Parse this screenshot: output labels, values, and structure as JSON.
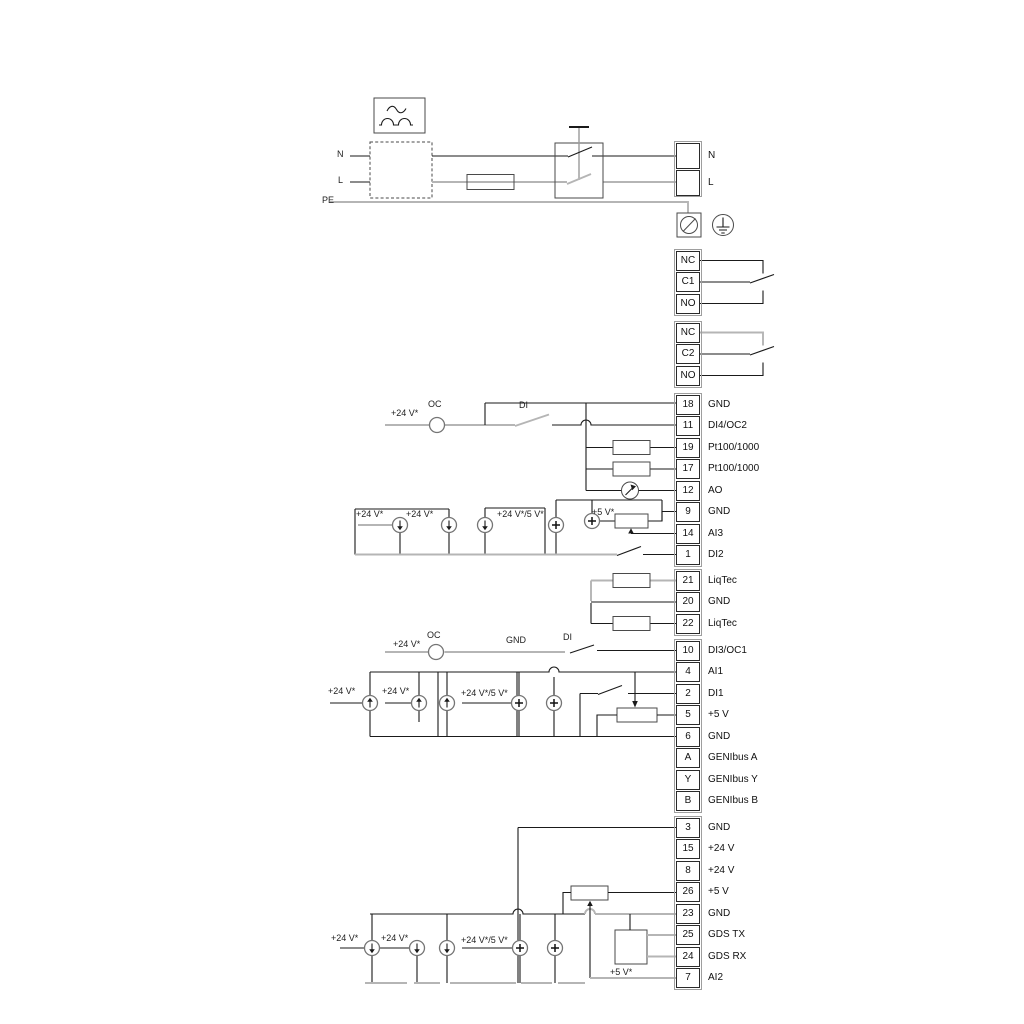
{
  "colors": {
    "wire_black": "#1a1a1a",
    "wire_gray": "#b5b5b5",
    "text": "#111111",
    "background": "#ffffff"
  },
  "annotations": [
    {
      "name": "n-input-label",
      "text": "N",
      "x": 337,
      "y": 149
    },
    {
      "name": "l-input-label",
      "text": "L",
      "x": 338,
      "y": 175
    },
    {
      "name": "pe-label",
      "text": "PE",
      "x": 322,
      "y": 195
    },
    {
      "name": "oc2-supply-label",
      "text": "+24 V*",
      "x": 391,
      "y": 408
    },
    {
      "name": "oc2-label",
      "text": "OC",
      "x": 428,
      "y": 399
    },
    {
      "name": "di4-label",
      "text": "DI",
      "x": 519,
      "y": 400
    },
    {
      "name": "ai3-supply1-label",
      "text": "+24 V*",
      "x": 356,
      "y": 509
    },
    {
      "name": "ai3-supply2-label",
      "text": "+24 V*",
      "x": 406,
      "y": 509
    },
    {
      "name": "ai3-supply3-label",
      "text": "+24 V*/5 V*",
      "x": 497,
      "y": 509
    },
    {
      "name": "ai3-5v-label",
      "text": "+5 V*",
      "x": 592,
      "y": 507
    },
    {
      "name": "oc1-supply-label",
      "text": "+24 V*",
      "x": 393,
      "y": 639
    },
    {
      "name": "oc1-label",
      "text": "OC",
      "x": 427,
      "y": 630
    },
    {
      "name": "gnd-wire-label",
      "text": "GND",
      "x": 506,
      "y": 635
    },
    {
      "name": "di3-label",
      "text": "DI",
      "x": 563,
      "y": 632
    },
    {
      "name": "ai1-supply1-label",
      "text": "+24 V*",
      "x": 328,
      "y": 686
    },
    {
      "name": "ai1-supply2-label",
      "text": "+24 V*",
      "x": 382,
      "y": 686
    },
    {
      "name": "ai1-supply3-label",
      "text": "+24 V*/5 V*",
      "x": 461,
      "y": 688
    },
    {
      "name": "ai2-supply1-label",
      "text": "+24 V*",
      "x": 331,
      "y": 933
    },
    {
      "name": "ai2-supply2-label",
      "text": "+24 V*",
      "x": 381,
      "y": 933
    },
    {
      "name": "ai2-supply3-label",
      "text": "+24 V*/5 V*",
      "x": 461,
      "y": 935
    },
    {
      "name": "gds-5v-label",
      "text": "+5 V*",
      "x": 610,
      "y": 967
    }
  ],
  "terminal_groups": [
    {
      "name": "mains-terminals",
      "x": 676,
      "y": 143,
      "pitch": 26.5,
      "cell_h": 26,
      "label_x": 708,
      "rows": [
        {
          "num": "",
          "label": "N"
        },
        {
          "num": "",
          "label": "L"
        }
      ]
    },
    {
      "name": "relay-1-terminals",
      "x": 676,
      "y": 250.5,
      "pitch": 21.5,
      "cell_h": 20,
      "label_x": 708,
      "rows": [
        {
          "num": "NC",
          "label": ""
        },
        {
          "num": "C1",
          "label": ""
        },
        {
          "num": "NO",
          "label": ""
        }
      ]
    },
    {
      "name": "relay-2-terminals",
      "x": 676,
      "y": 322.5,
      "pitch": 21.5,
      "cell_h": 20,
      "label_x": 708,
      "rows": [
        {
          "num": "NC",
          "label": ""
        },
        {
          "num": "C2",
          "label": ""
        },
        {
          "num": "NO",
          "label": ""
        }
      ]
    },
    {
      "name": "io-terminals-1",
      "x": 676,
      "y": 394.5,
      "pitch": 21.5,
      "cell_h": 20,
      "label_x": 708,
      "rows": [
        {
          "num": "18",
          "label": "GND"
        },
        {
          "num": "11",
          "label": "DI4/OC2"
        },
        {
          "num": "19",
          "label": "Pt100/1000"
        },
        {
          "num": "17",
          "label": "Pt100/1000"
        },
        {
          "num": "12",
          "label": "AO"
        },
        {
          "num": "9",
          "label": "GND"
        },
        {
          "num": "14",
          "label": "AI3"
        },
        {
          "num": "1",
          "label": "DI2"
        }
      ]
    },
    {
      "name": "liqtec-terminals",
      "x": 676,
      "y": 570.5,
      "pitch": 21.5,
      "cell_h": 20,
      "label_x": 708,
      "rows": [
        {
          "num": "21",
          "label": "LiqTec"
        },
        {
          "num": "20",
          "label": "GND"
        },
        {
          "num": "22",
          "label": "LiqTec"
        }
      ]
    },
    {
      "name": "io-terminals-2",
      "x": 676,
      "y": 640.5,
      "pitch": 21.5,
      "cell_h": 20,
      "label_x": 708,
      "rows": [
        {
          "num": "10",
          "label": "DI3/OC1"
        },
        {
          "num": "4",
          "label": "AI1"
        },
        {
          "num": "2",
          "label": "DI1"
        },
        {
          "num": "5",
          "label": "+5 V"
        },
        {
          "num": "6",
          "label": "GND"
        },
        {
          "num": "A",
          "label": "GENIbus A"
        },
        {
          "num": "Y",
          "label": "GENIbus Y"
        },
        {
          "num": "B",
          "label": "GENIbus B"
        }
      ]
    },
    {
      "name": "io-terminals-3",
      "x": 676,
      "y": 817.5,
      "pitch": 21.5,
      "cell_h": 20,
      "label_x": 708,
      "rows": [
        {
          "num": "3",
          "label": "GND"
        },
        {
          "num": "15",
          "label": "+24 V"
        },
        {
          "num": "8",
          "label": "+24 V"
        },
        {
          "num": "26",
          "label": "+5 V"
        },
        {
          "num": "23",
          "label": "GND"
        },
        {
          "num": "25",
          "label": "GDS TX"
        },
        {
          "num": "24",
          "label": "GDS RX"
        },
        {
          "num": "7",
          "label": "AI2"
        }
      ]
    }
  ]
}
